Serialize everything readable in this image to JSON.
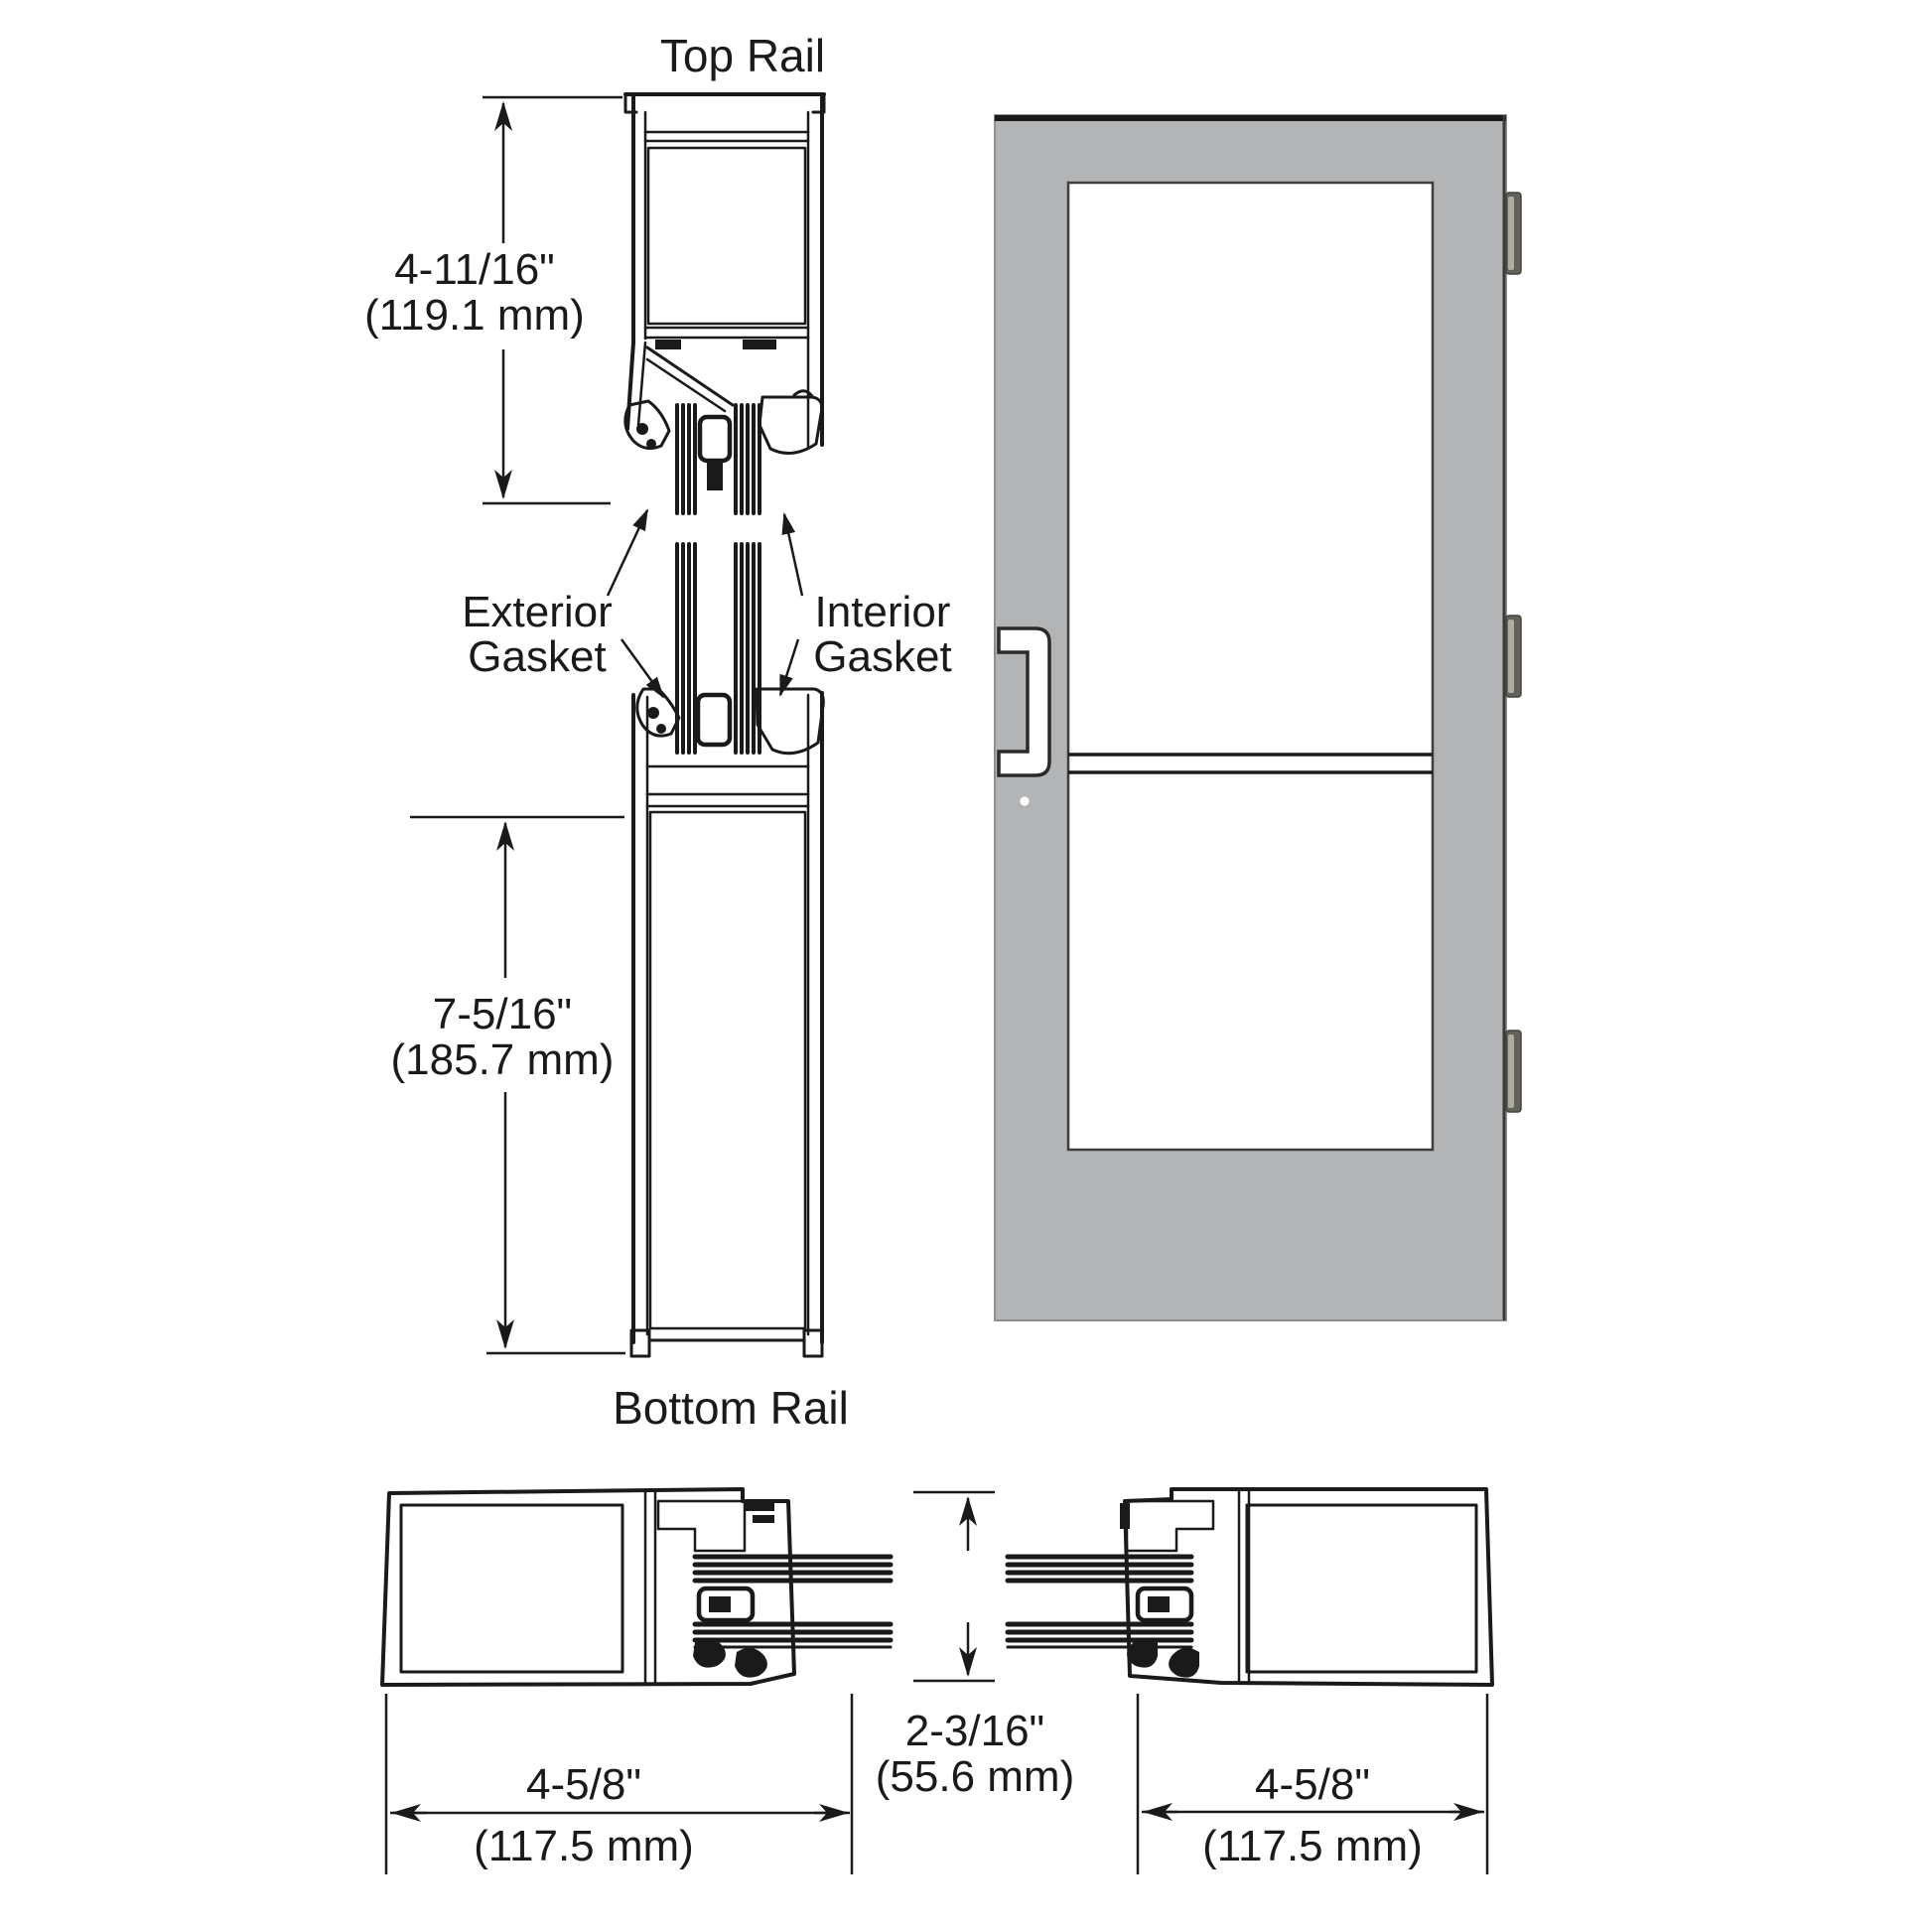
{
  "diagram": {
    "labels": {
      "top_rail": "Top Rail",
      "bottom_rail": "Bottom Rail",
      "exterior_gasket_line1": "Exterior",
      "exterior_gasket_line2": "Gasket",
      "interior_gasket_line1": "Interior",
      "interior_gasket_line2": "Gasket"
    },
    "dimensions": {
      "top_rail_height": {
        "inches": "4-11/16\"",
        "metric": "(119.1 mm)"
      },
      "bottom_rail_height": {
        "inches": "7-5/16\"",
        "metric": "(185.7 mm)"
      },
      "lock_stile_width": {
        "inches": "4-5/8\"",
        "metric": "(117.5 mm)"
      },
      "door_thickness": {
        "inches": "2-3/16\"",
        "metric": "(55.6 mm)"
      },
      "hinge_stile_width": {
        "inches": "4-5/8\"",
        "metric": "(117.5 mm)"
      }
    },
    "colors": {
      "door_gray": "#b2b4b6",
      "pocket_gray": "#c9cbcc",
      "hinge_dark": "#63625a",
      "hinge_light": "#aeaca2",
      "line": "#1a1a1a"
    }
  }
}
